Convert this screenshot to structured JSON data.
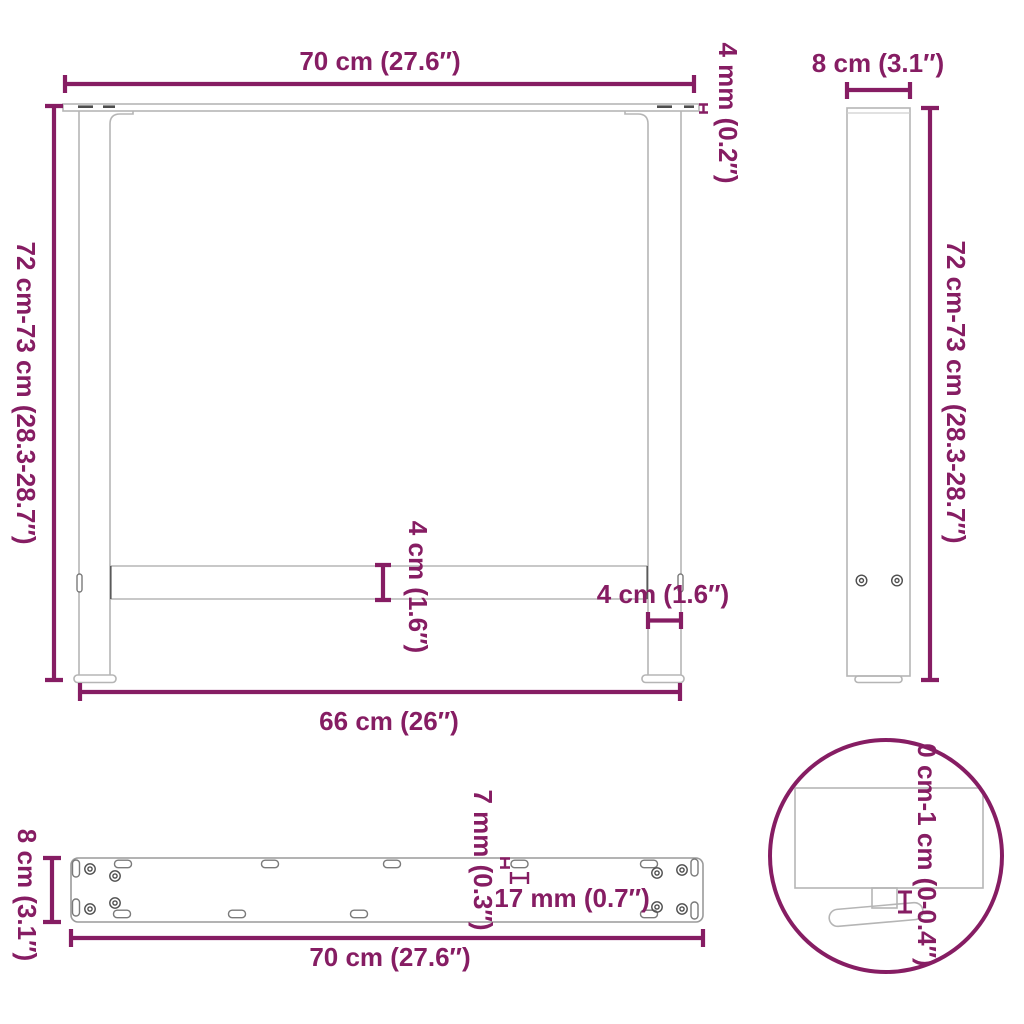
{
  "colors": {
    "accent": "#861D63",
    "line_art": "#b5b5b5",
    "detail_dark": "#4e4e4e",
    "background": "#ffffff"
  },
  "front": {
    "top_width": "70 cm (27.6″)",
    "plate_thickness": "4 mm (0.2″)",
    "height": "72 cm-73 cm (28.3-28.7″)",
    "crossbar_height": "4 cm (1.6″)",
    "leg_width": "4 cm (1.6″)",
    "feet_span": "66 cm (26″)"
  },
  "side": {
    "width": "8 cm (3.1″)",
    "height": "72 cm-73 cm (28.3-28.7″)"
  },
  "plate": {
    "depth": "8 cm (3.1″)",
    "hole_width": "7 mm (0.3″)",
    "hole_length": "17 mm (0.7″)",
    "width": "70 cm (27.6″)"
  },
  "detail": {
    "adjustable_height": "0 cm-1 cm (0-0.4″)"
  }
}
